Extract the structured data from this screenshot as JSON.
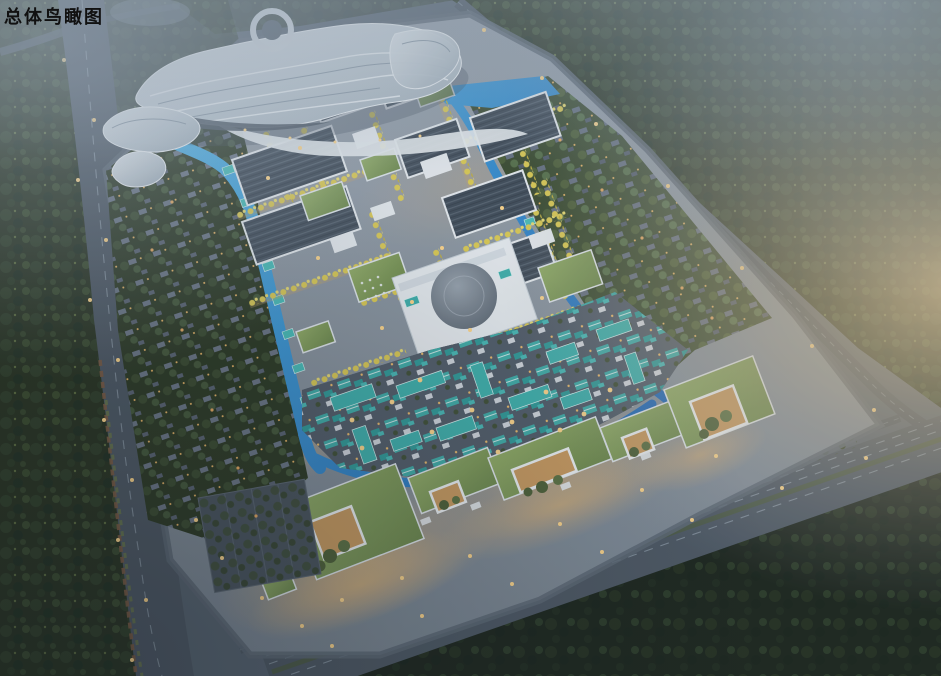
{
  "header": {
    "title": "总体鸟瞰图"
  },
  "colors": {
    "base": "#57626e",
    "haze_warm": "#d8c49c",
    "haze_cool": "#a9b6c4",
    "forest": "#28321f",
    "forest_dark": "#1c241b",
    "road": "#4d5762",
    "road_light": "#6b7683",
    "ground": "#98a1ab",
    "ground_deep": "#7a8590",
    "water": "#4fb6e8",
    "water_deep": "#1d5fb0",
    "hall_roof": "#414c58",
    "white_building": "#e7ebee",
    "green_roof": "#6e894c",
    "yellow_tree": "#dcca52",
    "teal_roof": "#3fb0ab",
    "villa_trees": "#2c3822",
    "villa_trees_light": "#3c4c30",
    "warm_light": "#ffd68a",
    "plaza_warm": "#deb274",
    "dome": "#5d6772",
    "building_body": "#dfe6ea",
    "title": "#111111"
  }
}
